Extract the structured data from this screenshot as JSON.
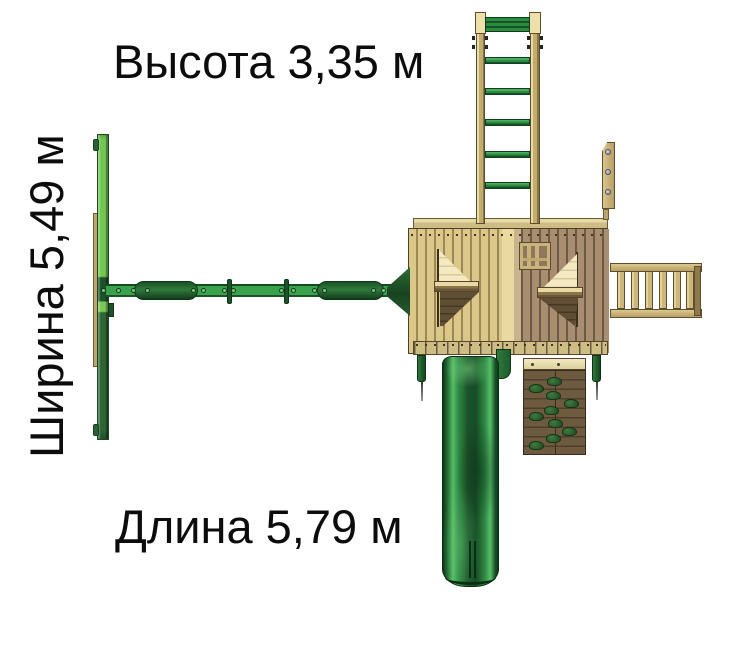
{
  "dimensions": {
    "height": {
      "text": "Высота 3,35 м",
      "name": "Высота",
      "value": "3,35",
      "unit": "м"
    },
    "width": {
      "text": "Ширина 5,49 м",
      "name": "Ширина",
      "value": "5,49",
      "unit": "м"
    },
    "length": {
      "text": "Длина 5,79 м",
      "name": "Длина",
      "value": "5,79",
      "unit": "м"
    }
  },
  "colors": {
    "background": "#ffffff",
    "text": "#0c0c0c",
    "swing_light_green": "#74c653",
    "swing_dark_green": "#2d6535",
    "beam_green": "#3aa14c",
    "slide_green": "#1a5c2b",
    "slide_highlight": "#58bd68",
    "wood_light": "#dbc787",
    "wood_dark": "#a88e70",
    "wood_cream": "#f2e8c2",
    "rockwall_brown": "#5f4d34"
  }
}
